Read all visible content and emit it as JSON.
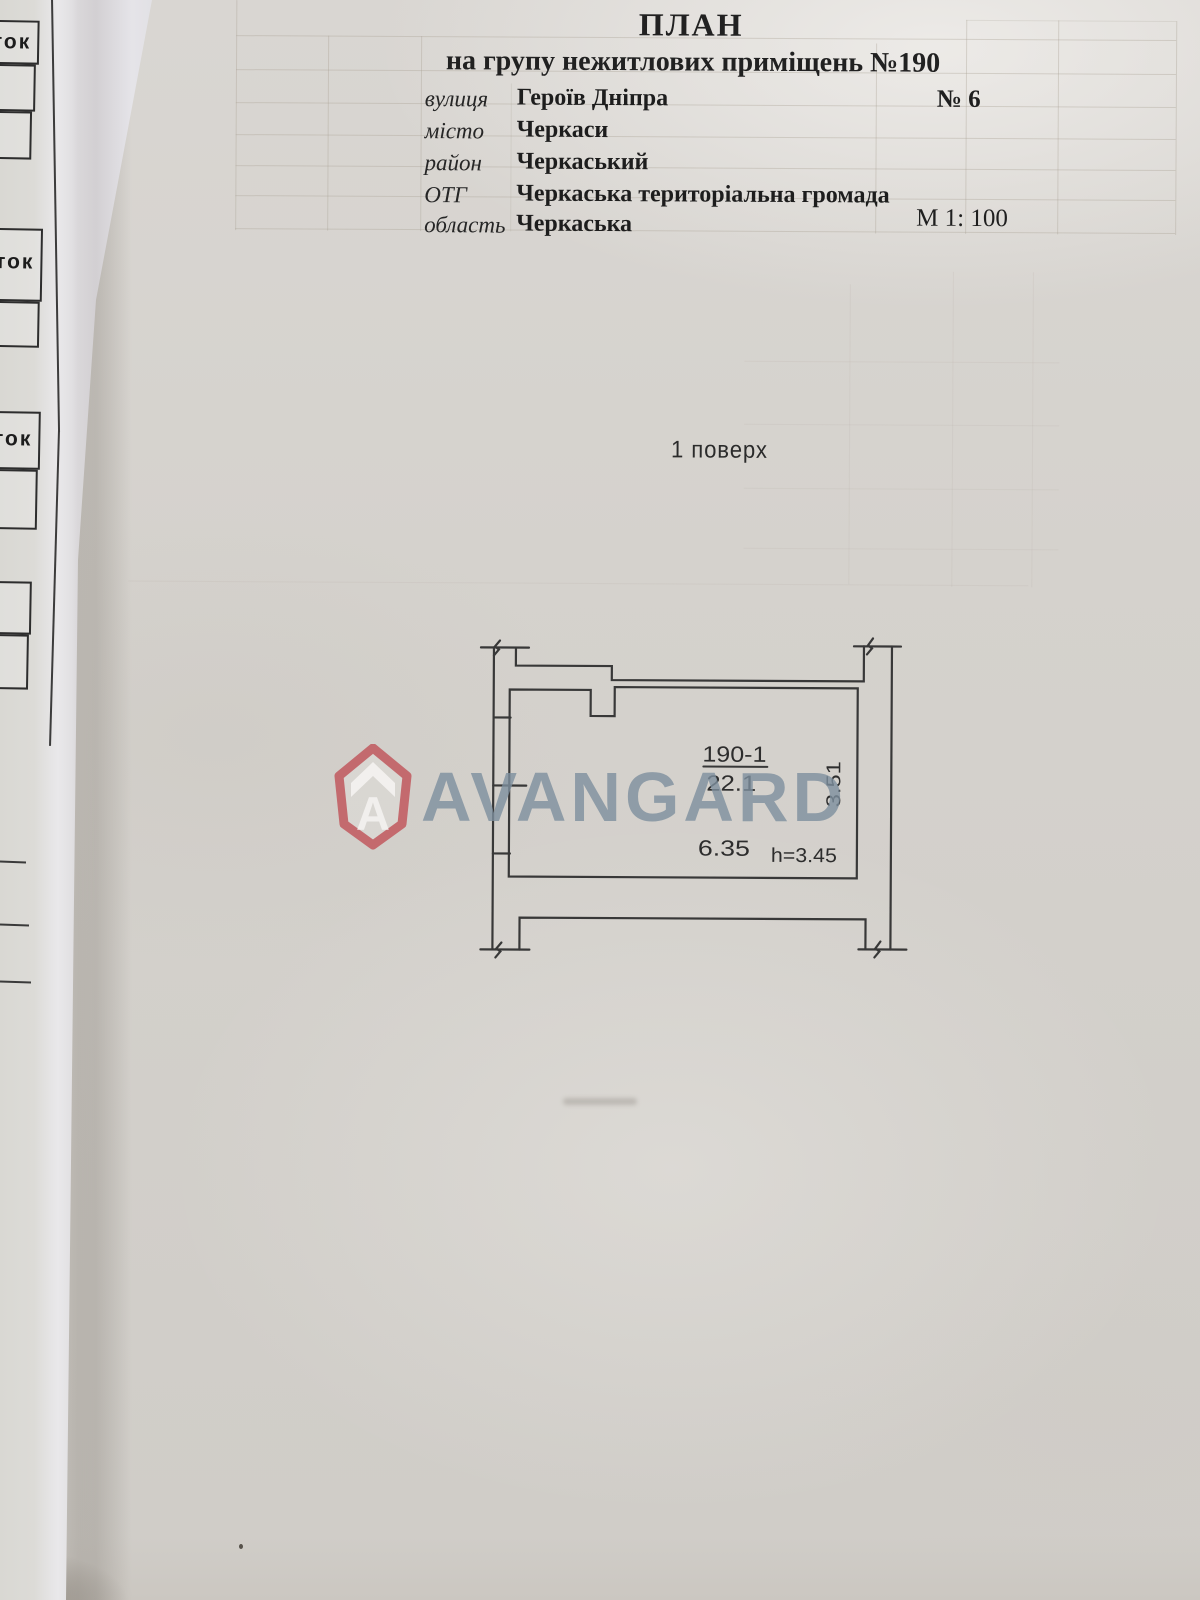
{
  "header": {
    "title": "ПЛАН",
    "subtitle": "на групу нежитлових приміщень №190",
    "fields": [
      {
        "label": "вулиця",
        "value": "Героїв Дніпра",
        "extra": "№ 6"
      },
      {
        "label": "місто",
        "value": "Черкаси",
        "extra": ""
      },
      {
        "label": "район",
        "value": "Черкаський",
        "extra": ""
      },
      {
        "label": "ОТГ",
        "value": "Черкаська територіальна громада",
        "extra": ""
      },
      {
        "label": "область",
        "value": "Черкаська",
        "extra": "М 1: 100"
      }
    ]
  },
  "drawing": {
    "floor_label": "1 поверх",
    "room": {
      "number": "190-1",
      "area": "22.1",
      "width_m": "6.35",
      "depth_m": "3.51",
      "height_label": "h=3.45"
    }
  },
  "watermark": {
    "brand": "AVANGARD",
    "logo_letter": "A",
    "text_color": "#7d8f9d",
    "logo_color": "#c25d62"
  },
  "underlying_page": {
    "fragments": [
      "ток",
      "ток",
      "ток"
    ]
  },
  "colors": {
    "paper": "#d5d2cd",
    "ink": "#2f2f2f",
    "faint_grid": "#aaa296"
  }
}
